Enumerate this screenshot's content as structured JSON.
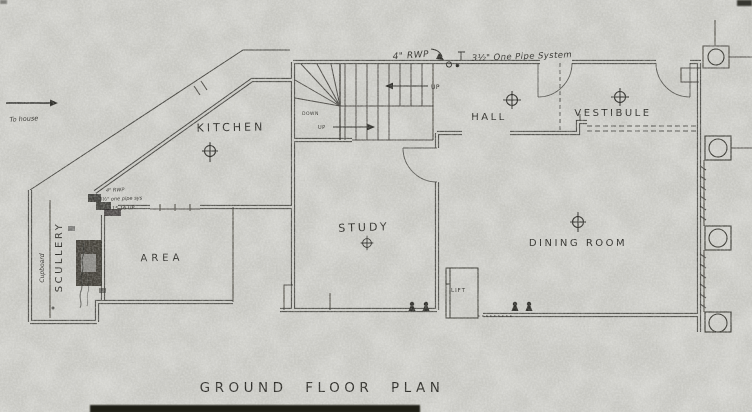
{
  "plan": {
    "title": "GROUND FLOOR PLAN",
    "rooms": {
      "kitchen": "KITCHEN",
      "scullery": "SCULLERY",
      "cupboard": "Cupboard",
      "area": "AREA",
      "study": "STUDY",
      "hall": "HALL",
      "vestibule": "VESTIBULE",
      "dining_room": "DINING ROOM",
      "lift": "LIFT"
    },
    "plumbing": {
      "rwp": "4\" RWP",
      "one_pipe": "3½\" One Pipe System",
      "area_rwp": "4\" RWP",
      "area_pipe": "3½\" one pipe sys",
      "area_up": "15 16 UP"
    },
    "stairs": {
      "up_main": "UP",
      "up_lower": "UP",
      "down": "DOWN"
    },
    "misc": {
      "to_house": "To house"
    },
    "colors": {
      "paper": "#c9c9c4",
      "ink": "#2e2d29"
    }
  }
}
